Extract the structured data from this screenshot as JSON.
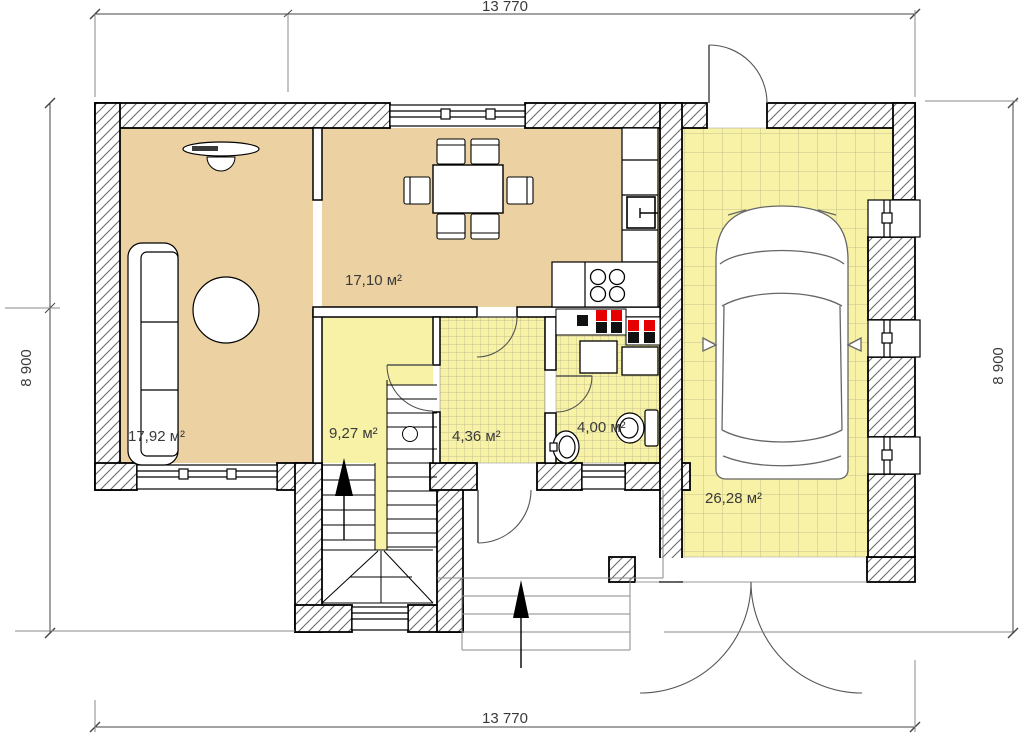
{
  "plan": {
    "dimensions": {
      "width_top": "13 770",
      "width_bottom": "13 770",
      "height_left": "8 900",
      "height_right": "8 900"
    },
    "rooms": {
      "living_room": {
        "area": "17,92 м²"
      },
      "kitchen_dining": {
        "area": "17,10 м²"
      },
      "hallway": {
        "area": "9,27 м²"
      },
      "storage": {
        "area": "4,36 м²"
      },
      "bathroom": {
        "area": "4,00 м²"
      },
      "garage": {
        "area": "26,28 м²"
      }
    },
    "colors": {
      "floor_tan": "#ecd2a2",
      "floor_yellow": "#f7f2a6",
      "vent_red": "#e60000",
      "vent_black": "#111111",
      "wall_outline": "#000000"
    }
  }
}
